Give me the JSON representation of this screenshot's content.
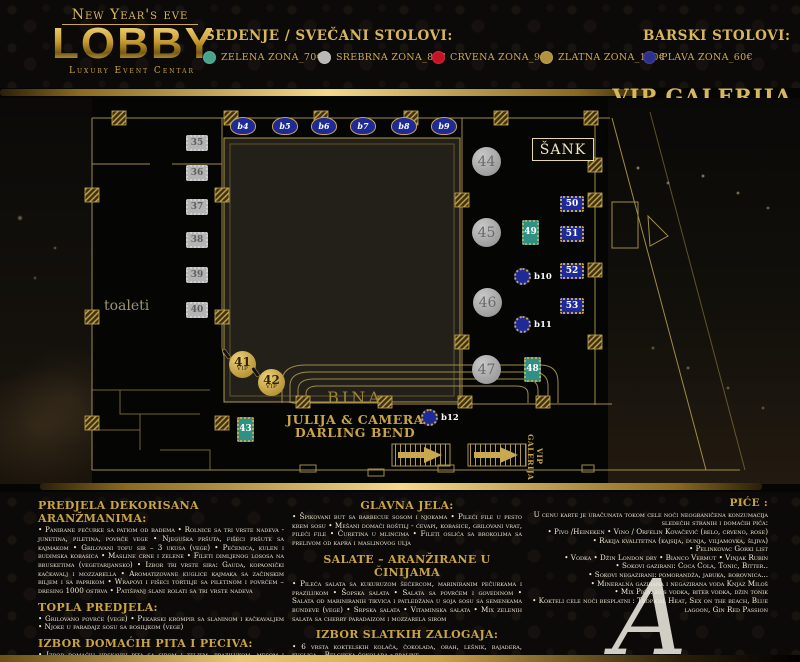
{
  "header": {
    "logo": {
      "top_line": "New Year's eve",
      "name": "LOBBY",
      "subtitle": "Luxury Event Centar"
    },
    "legend_title": "SEDENJE / SVEČANI STOLOVI:",
    "bar_title": "BARSKI STOLOVI:",
    "zones": [
      {
        "label": "ZELENA ZONA_70€",
        "color": "#45a58d"
      },
      {
        "label": "SREBRNA ZONA_85€",
        "color": "#b9b9b9"
      },
      {
        "label": "CRVENA ZONA_95€",
        "color": "#c61225"
      },
      {
        "label": "ZLATNA ZONA_100€",
        "color": "#b2913f"
      },
      {
        "label": "PLAVA ZONA_60€",
        "color": "#2b2f8e"
      }
    ]
  },
  "vip_galerija_heading": "VIP GALERIJA",
  "plan": {
    "sank_label": "ŠANK",
    "toaleti_label": "toaleti",
    "bina_label": "BINA",
    "band_line1": "JULIJA & CAMERA",
    "band_line2": "DARLING BEND",
    "vip_galerija_vertical": "VIP GALERIJA",
    "tables": {
      "bar_top": [
        "b4",
        "b5",
        "b6",
        "b7",
        "b8",
        "b9"
      ],
      "silver_rect": [
        "35",
        "36",
        "37",
        "38",
        "39",
        "40"
      ],
      "silver_round": [
        "44",
        "45",
        "46",
        "47"
      ],
      "blue_rect": [
        "50",
        "51",
        "52",
        "53"
      ],
      "teal_rect": [
        "49",
        "48",
        "43"
      ],
      "blue_round": [
        "b10",
        "b11",
        "b12"
      ],
      "vip_gold": [
        {
          "num": "41",
          "tag": "VIP"
        },
        {
          "num": "42",
          "tag": "VIP"
        }
      ]
    }
  },
  "menu": {
    "left_sections": [
      {
        "title": "PREDJELA DEKORISANA ARANŽMANIMA:",
        "body": "• Panirane pečurke sa patiom od badema • Rolnice sa tri vrste nadeva - junetina, piletina, povrće vege • Njeguška pršuta, fišeci pršute sa kajmakom • Grilovani tofu sir – 3 ukusa (vege) • Pečenica, kulen i budimska kobasica • Masline crne i zelene • Fileti dimljenog lososa na brusketima (vegetarijansko) • Izbor tri vrste sira: Gauda, kopaonički kačkavalj i mozzarella • Aromatizovane kuglice kajmaka sa začinskim biljem i sa paprikom • Wrapovi i fišeci tortilje sa piletinom i povrćem – dresing 1000 ostrva • Patišpanj slani rolati sa tri vrste nadeva"
      },
      {
        "title": "TOPLA PREDJELA:",
        "body": "• Grilovano povrće (vege) • Pekarski krompir sa slaninom i kačkavaljem • Njoke u paradajz sosu sa bosiljkom (vege)"
      },
      {
        "title": "IZBOR DOMAĆIH PITA I PECIVA:",
        "body": "• Izbor domaćih hrskavih pita sa sirom i zeljem, prazilukom, mesom i pečurkama • Integralno pecivo sa ražanim posipom bez aditiva • Bele zemičke sa susamom • Koktelske kifle i kajzerice sa raznim posipima"
      }
    ],
    "center_sections": [
      {
        "title": "GLAVNA JELA:",
        "body": "• Špikovani but sa barbecue sosom i njokama • Pileći file u pesto krem sosu • Mešani domaći roštilj - ćevapi, kobasice, grilovani vrat, pileći file • Ćuretina u mlincima • Fileti oslića sa brokolima sa prelivom od kapra i maslinovog ulja"
      },
      {
        "title": "SALATE – ARANŽIRANE U ČINIJAMA",
        "body": "• Pileća salata sa kukuruzom šećercom, mariniranim pečurkama i prazilukom • Šopska salata • Salata sa povrćem i govedinom • Salata od mariniranih tikvica i patledžana u soja sosu sa semenkama bundeve (vege) • Srpska salata • Vitaminska salata • Mix zelenih salata sa cherry paradaizom i mozzarela sirom"
      },
      {
        "title": "IZBOR SLATKIH ZALOGAJA:",
        "body": "• 6 vrsta koktelskih kolača, čokolada, orah, lešnik, bajadera, kuglica – Belgijska čokolada - praline"
      }
    ],
    "drinks": {
      "title": "PIĆE :",
      "intro": "U cenu karte je uračunata tokom cele noći neograničena konzumacija sledećih stranih i domaćih pića:",
      "items": [
        "• Pivo /Heineken • Vino / Orfelin Kovačević (belo, crveno, rose)",
        "• Rakija kvalitetna (kajsija, dunja, viljamovka, šljiva)",
        "• Pelinkovac Gorki list",
        "• Vodka • Džin London dry • Bianco Vermut • Vinjak Rubin",
        "• Sokovi gazirani: Coca Cola, Tonic, Bitter..",
        "• Sokovi negazirani: pomorandža, jabuka, borovnica...",
        "• Mineralna gazirana i negazirana voda Knjaz Miloš",
        "• Mix Pića: đus vodka, biter vodka, džin tonik",
        "• Kokteli cele noći besplatni : Tropical Heat, Sex on the beach, Blue lagoon, Gin Red Passion"
      ]
    }
  },
  "watermark": "A"
}
